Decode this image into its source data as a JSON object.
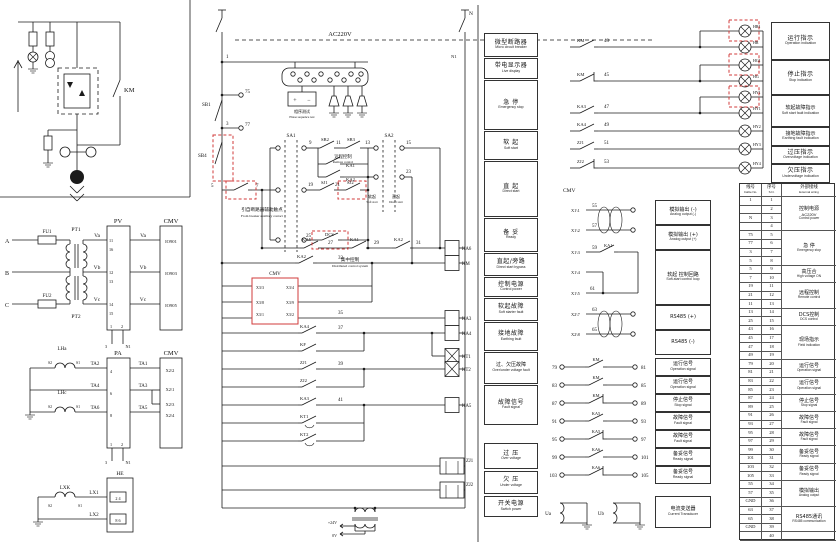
{
  "palette": {
    "line": "#1b1b1b",
    "red": "#d23b3b",
    "bg": "#ffffff"
  },
  "labels": [
    [
      "KM",
      124,
      92,
      6.5,
      "s"
    ],
    [
      "A",
      5,
      243,
      6,
      "s"
    ],
    [
      "B",
      5,
      275,
      6,
      "s"
    ],
    [
      "C",
      5,
      307,
      6,
      "s"
    ],
    [
      "FU1",
      47,
      233,
      5,
      "m"
    ],
    [
      "FU2",
      47,
      297,
      5,
      "m"
    ],
    [
      "PT1",
      76,
      231,
      5.5,
      "m"
    ],
    [
      "PT2",
      76,
      318,
      5.5,
      "m"
    ],
    [
      "Va",
      97,
      237,
      5.5,
      "m"
    ],
    [
      "Vb",
      97,
      269,
      5.5,
      "m"
    ],
    [
      "Vc",
      97,
      301,
      5.5,
      "m"
    ],
    [
      "PV",
      118,
      223,
      6.5,
      "m"
    ],
    [
      "CMV",
      171,
      223,
      6.5,
      "m"
    ],
    [
      "11",
      109,
      242,
      4.2,
      "s"
    ],
    [
      "16",
      109,
      251,
      4.2,
      "s"
    ],
    [
      "12",
      109,
      274,
      4.2,
      "s"
    ],
    [
      "13",
      109,
      283,
      4.2,
      "s"
    ],
    [
      "14",
      109,
      306,
      4.2,
      "s"
    ],
    [
      "15",
      109,
      315,
      4.2,
      "s"
    ],
    [
      "1",
      110,
      328,
      4.2,
      "s"
    ],
    [
      "2",
      121,
      328,
      4.2,
      "s"
    ],
    [
      "3",
      106,
      348,
      4.2,
      "m"
    ],
    [
      "N1",
      128,
      348,
      4.2,
      "m"
    ],
    [
      "Va",
      143,
      237,
      5.5,
      "m"
    ],
    [
      "Vb",
      143,
      269,
      5.5,
      "m"
    ],
    [
      "Vc",
      143,
      301,
      5.5,
      "m"
    ],
    [
      "IO901",
      171,
      243,
      4.6,
      "m"
    ],
    [
      "IO903",
      171,
      275,
      4.6,
      "m"
    ],
    [
      "IO905",
      171,
      307,
      4.6,
      "m"
    ],
    [
      "LHa",
      62,
      350,
      5,
      "m"
    ],
    [
      "LHc",
      62,
      394,
      5,
      "m"
    ],
    [
      "S2",
      50,
      364,
      3.8,
      "m"
    ],
    [
      "S1",
      78,
      364,
      3.8,
      "m"
    ],
    [
      "S2",
      50,
      408,
      3.8,
      "m"
    ],
    [
      "S1",
      78,
      408,
      3.8,
      "m"
    ],
    [
      "TA2",
      95,
      365,
      5,
      "m"
    ],
    [
      "TA4",
      95,
      387,
      5,
      "m"
    ],
    [
      "TA6",
      95,
      409,
      5,
      "m"
    ],
    [
      "PA",
      118,
      355,
      6.5,
      "m"
    ],
    [
      "CMV",
      171,
      355,
      6.5,
      "m"
    ],
    [
      "4",
      110,
      373,
      4.2,
      "s"
    ],
    [
      "6",
      110,
      395,
      4.2,
      "s"
    ],
    [
      "8",
      110,
      417,
      4.2,
      "s"
    ],
    [
      "TA1",
      143,
      365,
      5,
      "m"
    ],
    [
      "TA3",
      143,
      387,
      5,
      "m"
    ],
    [
      "TA5",
      143,
      409,
      5,
      "m"
    ],
    [
      "X2\\2",
      170,
      372,
      4.4,
      "m"
    ],
    [
      "X2\\1",
      170,
      391,
      4.4,
      "m"
    ],
    [
      "X2\\3",
      170,
      406,
      4.4,
      "m"
    ],
    [
      "X2\\4",
      170,
      417,
      4.4,
      "m"
    ],
    [
      "1",
      110,
      446,
      4.2,
      "s"
    ],
    [
      "2",
      121,
      446,
      4.2,
      "s"
    ],
    [
      "3",
      106,
      464,
      4.2,
      "m"
    ],
    [
      "N1",
      128,
      464,
      4.2,
      "m"
    ],
    [
      "LXK",
      65,
      489,
      5,
      "m"
    ],
    [
      "S2",
      50,
      507,
      3.8,
      "m"
    ],
    [
      "S1",
      80,
      507,
      3.8,
      "m"
    ],
    [
      "LX1",
      94,
      494,
      5,
      "m"
    ],
    [
      "LX2",
      94,
      516,
      5,
      "m"
    ],
    [
      "HE",
      120,
      475,
      5.5,
      "m"
    ],
    [
      "2  4",
      118,
      500,
      4.2,
      "m"
    ],
    [
      "8  6",
      118,
      522,
      4.2,
      "m"
    ],
    [
      "1",
      226,
      58,
      5,
      "s"
    ],
    [
      "AC220V",
      340,
      36,
      6.5,
      "m"
    ],
    [
      "N",
      469,
      15,
      5.5,
      "s"
    ],
    [
      "N1",
      451,
      58,
      4.6,
      "s"
    ],
    [
      "SB1",
      202,
      106,
      5,
      "s"
    ],
    [
      "75",
      245,
      93,
      5,
      "s"
    ],
    [
      "77",
      245,
      126,
      5,
      "s"
    ],
    [
      "3",
      226,
      125,
      5,
      "s"
    ],
    [
      "SB4",
      198,
      157,
      5,
      "s"
    ],
    [
      "5",
      211,
      187,
      5,
      "s"
    ],
    [
      "7",
      256,
      187,
      5,
      "s"
    ],
    [
      "引自断路器辅助触点",
      262,
      211,
      4.6,
      "m"
    ],
    [
      "From breaker auxiliary contact",
      262,
      217,
      3.4,
      "m"
    ],
    [
      "SA1",
      291,
      137,
      5,
      "m"
    ],
    [
      "SA2",
      389,
      137,
      5,
      "m"
    ],
    [
      "9",
      309,
      144,
      5,
      "s"
    ],
    [
      "SB2",
      321,
      141,
      4.6,
      "s"
    ],
    [
      "11",
      336,
      144,
      5,
      "s"
    ],
    [
      "SB3",
      347,
      141,
      4.6,
      "s"
    ],
    [
      "13",
      365,
      144,
      5,
      "s"
    ],
    [
      "远程控制",
      343,
      158,
      4.4,
      "m"
    ],
    [
      "Remote control",
      343,
      163,
      3.3,
      "m"
    ],
    [
      "KA1",
      346,
      167,
      4.6,
      "s"
    ],
    [
      "KA2",
      346,
      181,
      4.6,
      "s"
    ],
    [
      "19",
      308,
      186,
      5,
      "s"
    ],
    [
      "SJ1",
      321,
      184,
      4.6,
      "s"
    ],
    [
      "21",
      335,
      186,
      5,
      "s"
    ],
    [
      "SJ2",
      347,
      184,
      4.6,
      "s"
    ],
    [
      "25",
      306,
      237,
      5,
      "s"
    ],
    [
      "DCS",
      325,
      236,
      4.6,
      "s"
    ],
    [
      "集中控制",
      350,
      261,
      4.6,
      "m"
    ],
    [
      "Distributed control system",
      350,
      267,
      3.4,
      "m"
    ],
    [
      "15",
      406,
      144,
      5,
      "s"
    ],
    [
      "23",
      406,
      173,
      5,
      "s"
    ],
    [
      "软起",
      372,
      198,
      4,
      "m"
    ],
    [
      "Soft start",
      372,
      203,
      3.1,
      "m"
    ],
    [
      "直起",
      396,
      198,
      4,
      "m"
    ],
    [
      "Direct start",
      396,
      203,
      3.1,
      "m"
    ],
    [
      "KA5",
      302,
      241,
      4.6,
      "s"
    ],
    [
      "27",
      328,
      244,
      5,
      "s"
    ],
    [
      "KA1",
      350,
      241,
      4.6,
      "s"
    ],
    [
      "29",
      374,
      244,
      5,
      "s"
    ],
    [
      "KA2",
      394,
      241,
      4.6,
      "s"
    ],
    [
      "31",
      416,
      244,
      5,
      "s"
    ],
    [
      "KA6",
      462,
      250,
      4.8,
      "s"
    ],
    [
      "KA2",
      297,
      258,
      4.6,
      "s"
    ],
    [
      "33",
      338,
      259,
      5,
      "s"
    ],
    [
      "KM",
      462,
      265,
      4.8,
      "s"
    ],
    [
      "CMV",
      275,
      275,
      5,
      "m"
    ],
    [
      "X3/3",
      256,
      289,
      4,
      "s"
    ],
    [
      "X3/4",
      294,
      289,
      4,
      "e"
    ],
    [
      "X3/8",
      256,
      304,
      4,
      "s"
    ],
    [
      "X3/9",
      294,
      304,
      4,
      "e"
    ],
    [
      "X3/1",
      256,
      316,
      4,
      "s"
    ],
    [
      "X3/2",
      294,
      316,
      4,
      "e"
    ],
    [
      "35",
      338,
      314,
      5,
      "s"
    ],
    [
      "KA3",
      462,
      320,
      4.8,
      "s"
    ],
    [
      "KA4",
      300,
      328,
      4.6,
      "s"
    ],
    [
      "37",
      338,
      329,
      5,
      "s"
    ],
    [
      "KA4",
      462,
      335,
      4.8,
      "s"
    ],
    [
      "KT1",
      462,
      358,
      4.8,
      "s"
    ],
    [
      "KF",
      300,
      346,
      4.6,
      "s"
    ],
    [
      "ZJ1",
      300,
      364,
      4.6,
      "s"
    ],
    [
      "39",
      338,
      365,
      5,
      "s"
    ],
    [
      "KT2",
      462,
      371,
      4.8,
      "s"
    ],
    [
      "ZJ2",
      300,
      382,
      4.6,
      "s"
    ],
    [
      "KA3",
      300,
      400,
      4.6,
      "s"
    ],
    [
      "41",
      338,
      401,
      5,
      "s"
    ],
    [
      "KA5",
      462,
      407,
      4.8,
      "s"
    ],
    [
      "KT1",
      300,
      418,
      4.6,
      "s"
    ],
    [
      "KT2",
      300,
      436,
      4.6,
      "s"
    ],
    [
      "ZJ1",
      466,
      462,
      4.8,
      "s"
    ],
    [
      "ZJ2",
      466,
      486,
      4.8,
      "s"
    ],
    [
      "+24V",
      337,
      524,
      4,
      "e"
    ],
    [
      "0V",
      337,
      537,
      4,
      "e"
    ],
    [
      "+",
      295,
      102,
      6,
      "m"
    ],
    [
      "−",
      309,
      102,
      6,
      "m"
    ],
    [
      "相序测试",
      302,
      113,
      4,
      "m"
    ],
    [
      "Phase sequence test",
      302,
      118,
      3.2,
      "m"
    ],
    [
      "KM",
      577,
      42,
      4.6,
      "s"
    ],
    [
      "43",
      604,
      42,
      5,
      "s"
    ],
    [
      "KM",
      577,
      76,
      4.6,
      "s"
    ],
    [
      "45",
      604,
      76,
      5,
      "s"
    ],
    [
      "KA3",
      577,
      108,
      4.6,
      "s"
    ],
    [
      "47",
      604,
      108,
      5,
      "s"
    ],
    [
      "KA4",
      577,
      126,
      4.6,
      "s"
    ],
    [
      "49",
      604,
      126,
      5,
      "s"
    ],
    [
      "ZJ1",
      577,
      144,
      4.6,
      "s"
    ],
    [
      "51",
      604,
      144,
      5,
      "s"
    ],
    [
      "ZJ2",
      577,
      163,
      4.6,
      "s"
    ],
    [
      "53",
      604,
      163,
      5,
      "s"
    ],
    [
      "HR1",
      753,
      28,
      4,
      "s"
    ],
    [
      "HR",
      753,
      44,
      4,
      "s"
    ],
    [
      "HG1",
      753,
      62,
      4,
      "s"
    ],
    [
      "HG",
      753,
      78,
      4,
      "s"
    ],
    [
      "HY1",
      753,
      94,
      4,
      "s"
    ],
    [
      "HY1",
      753,
      110,
      4,
      "s"
    ],
    [
      "HY2",
      753,
      128,
      4,
      "s"
    ],
    [
      "HY3",
      753,
      146,
      4,
      "s"
    ],
    [
      "HY4",
      753,
      165,
      4,
      "s"
    ],
    [
      "CMV",
      563,
      192,
      5.5,
      "s"
    ],
    [
      "X1\\1",
      571,
      212,
      4.4,
      "s"
    ],
    [
      "55",
      592,
      207,
      5,
      "s"
    ],
    [
      "X1\\2",
      571,
      232,
      4.4,
      "s"
    ],
    [
      "57",
      592,
      227,
      5,
      "s"
    ],
    [
      "X1\\3",
      571,
      254,
      4.4,
      "s"
    ],
    [
      "59",
      592,
      249,
      5,
      "s"
    ],
    [
      "KA1",
      604,
      247,
      4.4,
      "s"
    ],
    [
      "X1\\4",
      571,
      274,
      4.4,
      "s"
    ],
    [
      "X1\\5",
      571,
      295,
      4.4,
      "s"
    ],
    [
      "61",
      590,
      290,
      5,
      "s"
    ],
    [
      "X2\\7",
      571,
      316,
      4.4,
      "s"
    ],
    [
      "63",
      592,
      311,
      5,
      "s"
    ],
    [
      "X2\\8",
      571,
      336,
      4.4,
      "s"
    ],
    [
      "65",
      592,
      331,
      5,
      "s"
    ],
    [
      "79",
      557,
      369,
      5,
      "e"
    ],
    [
      "81",
      641,
      369,
      5,
      "s"
    ],
    [
      "KM",
      596,
      361,
      4.4,
      "m"
    ],
    [
      "83",
      557,
      387,
      5,
      "e"
    ],
    [
      "85",
      641,
      387,
      5,
      "s"
    ],
    [
      "KM",
      596,
      379,
      4.4,
      "m"
    ],
    [
      "87",
      557,
      405,
      5,
      "e"
    ],
    [
      "89",
      641,
      405,
      5,
      "s"
    ],
    [
      "KM",
      596,
      397,
      4.4,
      "m"
    ],
    [
      "91",
      557,
      423,
      5,
      "e"
    ],
    [
      "93",
      641,
      423,
      5,
      "s"
    ],
    [
      "KA5",
      596,
      415,
      4.4,
      "m"
    ],
    [
      "95",
      557,
      441,
      5,
      "e"
    ],
    [
      "97",
      641,
      441,
      5,
      "s"
    ],
    [
      "KA5",
      596,
      433,
      4.4,
      "m"
    ],
    [
      "99",
      557,
      459,
      5,
      "e"
    ],
    [
      "101",
      641,
      459,
      5,
      "s"
    ],
    [
      "KA6",
      596,
      451,
      4.4,
      "m"
    ],
    [
      "103",
      557,
      477,
      5,
      "e"
    ],
    [
      "105",
      641,
      477,
      5,
      "s"
    ],
    [
      "KA6",
      596,
      469,
      4.4,
      "m"
    ],
    [
      "Ua",
      551,
      515,
      5,
      "e"
    ],
    [
      "Ub",
      604,
      515,
      5,
      "e"
    ]
  ],
  "function_boxes": [
    {
      "zh": "微型断路器",
      "en": "Micro circuit breaker"
    },
    {
      "zh": "带电显示器",
      "en": "Live display"
    },
    {
      "zh": "急  停",
      "en": "Emergency stop"
    },
    {
      "zh": "软  起",
      "en": "Soft start"
    },
    {
      "zh": "直  起",
      "en": "Direct start"
    },
    {
      "zh": "备  妥",
      "en": "Ready"
    },
    {
      "zh": "直起/旁路",
      "en": "Direct start bypass"
    },
    {
      "zh": "控制电源",
      "en": "Control power"
    },
    {
      "zh": "软起故障",
      "en": "Soft starter fault"
    },
    {
      "zh": "接地故障",
      "en": "Earthing fault"
    },
    {
      "zh": "过、欠压故障",
      "en": "Over/under voltage fault"
    },
    {
      "zh": "故障信号",
      "en": "Fault signal"
    },
    {
      "zh": "过  压",
      "en": "Over voltage"
    },
    {
      "zh": "欠  压",
      "en": "Under voltage"
    },
    {
      "zh": "开关电源",
      "en": "Switch power"
    }
  ],
  "lamp_boxes": [
    {
      "zh": "运行指示",
      "en": "Operation indication"
    },
    {
      "zh": "停止指示",
      "en": "Stop indication"
    },
    {
      "zh": "软起故障指示",
      "en": "Soft start fault indication"
    },
    {
      "zh": "接地故障指示",
      "en": "Earthing fault indication"
    },
    {
      "zh": "过压指示",
      "en": "Overvoltage indication"
    },
    {
      "zh": "欠压指示",
      "en": "Undervoltage indication"
    }
  ],
  "cmv_boxes": [
    {
      "zh": "模拟输出 (-)",
      "en": "Analog output (-)"
    },
    {
      "zh": "模拟输出 (+)",
      "en": "Analog output (+)"
    },
    {
      "zh": "软起 控制回路",
      "en": "Soft-start control loop"
    },
    {
      "zh": "RS485 (+)",
      "en": ""
    },
    {
      "zh": "RS485 (-)",
      "en": ""
    }
  ],
  "signal_boxes": [
    {
      "zh": "运行信号",
      "en": "Operation signal"
    },
    {
      "zh": "运行信号",
      "en": "Operation signal"
    },
    {
      "zh": "停止信号",
      "en": "Stop signal"
    },
    {
      "zh": "故障信号",
      "en": "Fault signal"
    },
    {
      "zh": "故障信号",
      "en": "Fault signal"
    },
    {
      "zh": "备妥信号",
      "en": "Ready signal"
    },
    {
      "zh": "备妥信号",
      "en": "Ready signal"
    }
  ],
  "transducer_box": {
    "zh": "电流变送器",
    "en": "Current Transducer"
  },
  "table": {
    "headers": [
      {
        "zh": "线号",
        "en": "Cable No."
      },
      {
        "zh": "序号",
        "en": "S.N."
      },
      {
        "zh": "外部接线",
        "en": "External wiring"
      }
    ],
    "line_numbers": [
      "1",
      "",
      "N",
      "",
      "75",
      "77",
      "3",
      "5",
      "5",
      "7",
      "19",
      "21",
      "11",
      "13",
      "25",
      "43",
      "45",
      "47",
      "49",
      "79",
      "81",
      "83",
      "85",
      "87",
      "89",
      "91",
      "93",
      "95",
      "97",
      "99",
      "101",
      "103",
      "105",
      "55",
      "57",
      "GND",
      "63",
      "65",
      "GND",
      ""
    ],
    "groups": [
      {
        "rows": 4,
        "zh": "控制电源",
        "en": "Control power",
        "extra": "AC220V"
      },
      {
        "rows": 4,
        "zh": "急 停",
        "en": "Emergency stop",
        "extra": ""
      },
      {
        "rows": 2,
        "zh": "高压合",
        "en": "High voltage ON",
        "extra": ""
      },
      {
        "rows": 3,
        "zh": "远程控制",
        "en": "Remote control",
        "extra": ""
      },
      {
        "rows": 2,
        "zh": "DCS控制",
        "en": "DCS control",
        "extra": ""
      },
      {
        "rows": 4,
        "zh": "现场指示",
        "en": "Field indication",
        "extra": ""
      },
      {
        "rows": 2,
        "zh": "运行信号",
        "en": "Operation signal",
        "extra": ""
      },
      {
        "rows": 2,
        "zh": "运行信号",
        "en": "Operation signal",
        "extra": ""
      },
      {
        "rows": 2,
        "zh": "停止信号",
        "en": "Stop signal",
        "extra": ""
      },
      {
        "rows": 2,
        "zh": "故障信号",
        "en": "Fault signal",
        "extra": ""
      },
      {
        "rows": 2,
        "zh": "故障信号",
        "en": "Fault signal",
        "extra": ""
      },
      {
        "rows": 2,
        "zh": "备妥信号",
        "en": "Ready signal",
        "extra": ""
      },
      {
        "rows": 2,
        "zh": "备妥信号",
        "en": "Ready signal",
        "extra": ""
      },
      {
        "rows": 3,
        "zh": "模拟输出",
        "en": "Analog output",
        "extra": ""
      },
      {
        "rows": 3,
        "zh": "RS485通讯",
        "en": "RS485 communication",
        "extra": ""
      },
      {
        "rows": 1,
        "zh": "",
        "en": "",
        "extra": ""
      }
    ]
  }
}
